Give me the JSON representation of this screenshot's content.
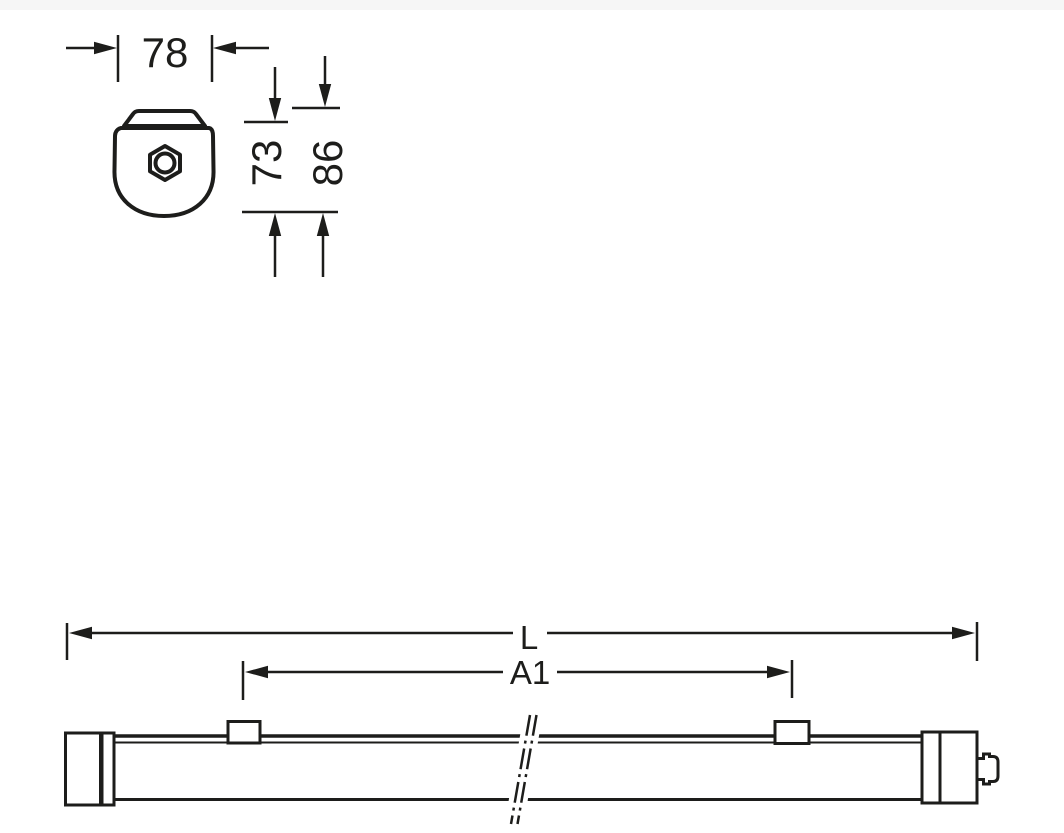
{
  "page": {
    "background": "#ffffff",
    "top_border_color": "#f6f6f6"
  },
  "drawing": {
    "line_color": "#1d1d1b",
    "cross_section_view": {
      "dim_width": {
        "label": "78"
      },
      "dim_height_body": {
        "label": "73"
      },
      "dim_height_total": {
        "label": "86"
      }
    },
    "side_view": {
      "dim_length": {
        "label": "L"
      },
      "dim_anchor_spacing": {
        "label": "A1"
      }
    }
  }
}
